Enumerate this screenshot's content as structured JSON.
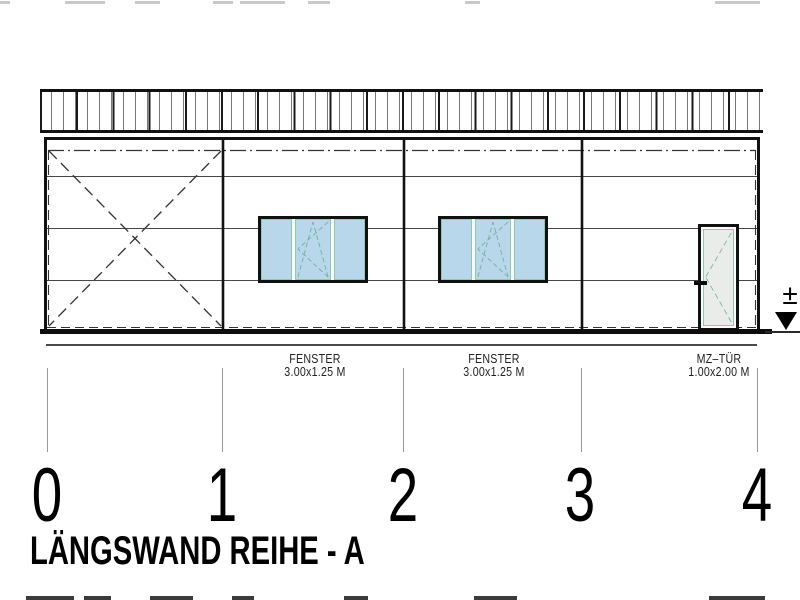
{
  "drawing": {
    "title": "LÄNGSWAND REIHE - A",
    "grid_labels": [
      "0",
      "1",
      "2",
      "3",
      "4"
    ],
    "annotations": {
      "fenster1": {
        "name": "FENSTER",
        "size": "3.00x1.25 M"
      },
      "fenster2": {
        "name": "FENSTER",
        "size": "3.00x1.25 M"
      },
      "tuer": {
        "name": "MZ–TÜR",
        "size": "1.00x2.00 M"
      }
    },
    "level_marker_symbol": "±",
    "colors": {
      "line": "#111111",
      "window_glass": "#b9d7eb",
      "door_glass": "#e9ece9",
      "opening_symbol": "#74b49e"
    }
  }
}
